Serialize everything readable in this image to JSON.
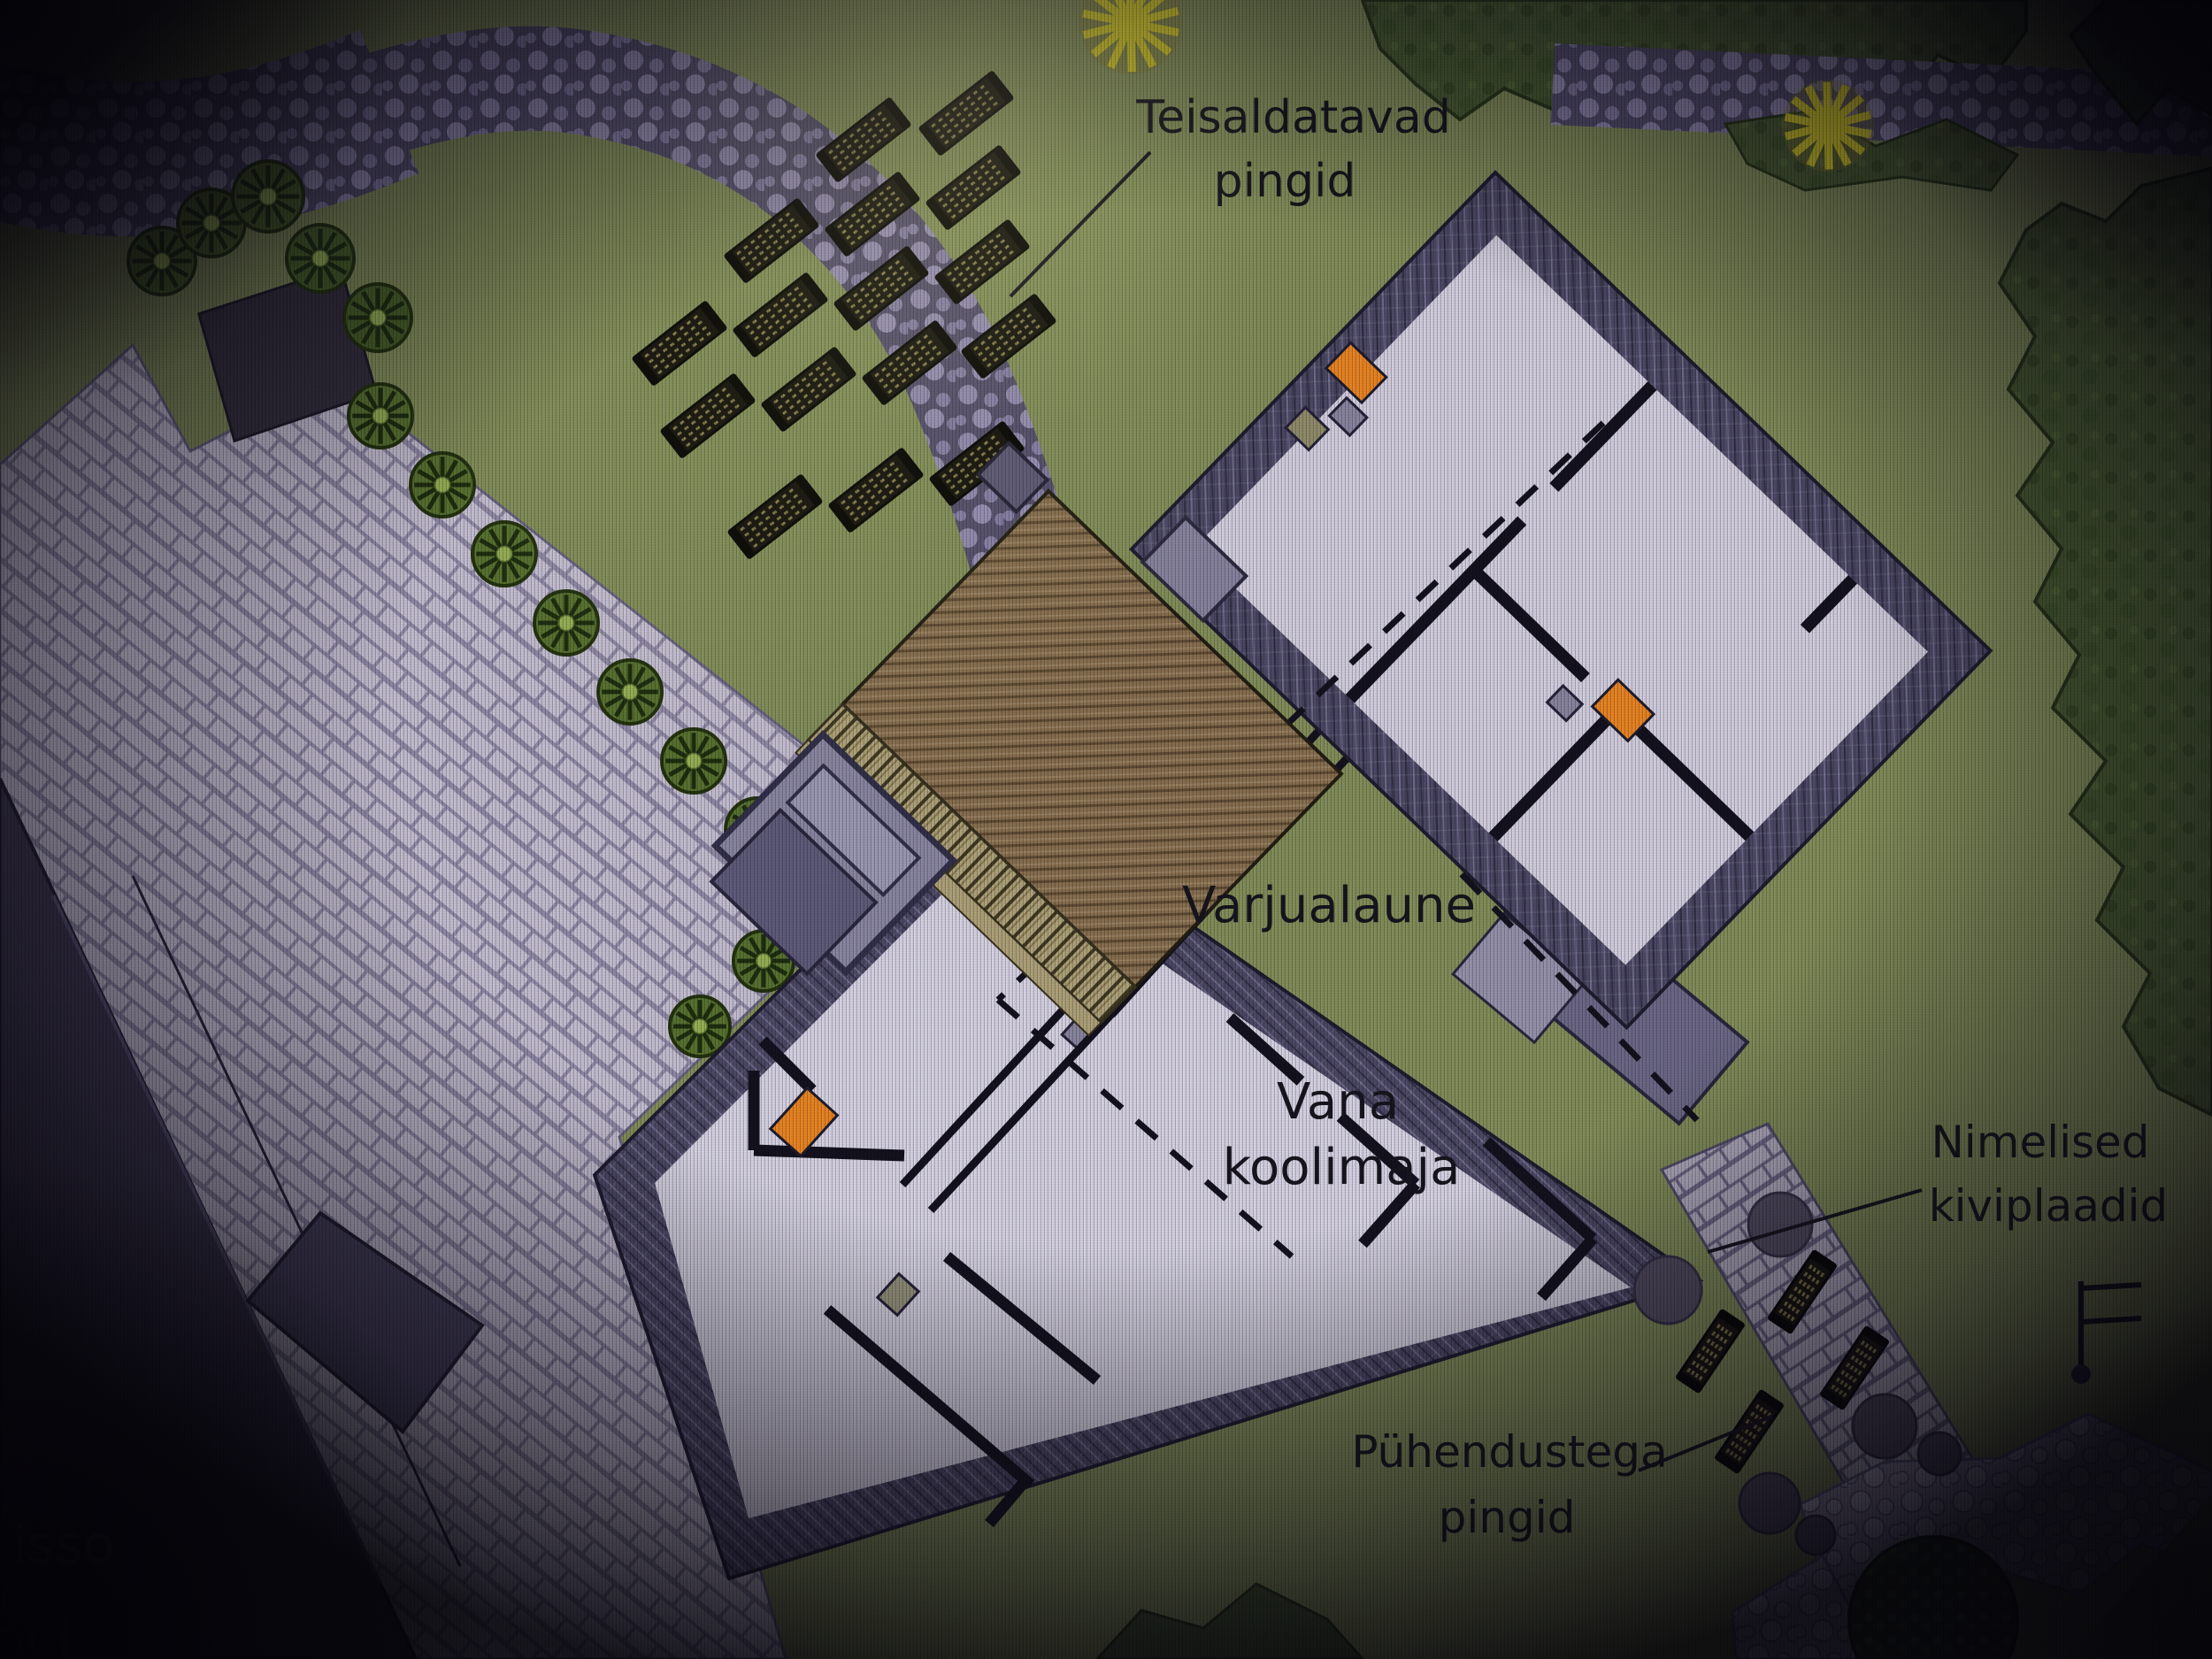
{
  "labels": {
    "teisaldatavad": {
      "line1": "Teisaldatavad",
      "line2": "pingid"
    },
    "varjualaune": {
      "line1": "Varjualaune"
    },
    "vana_koolimaja": {
      "line1": "Vana",
      "line2": "koolimaja"
    },
    "nimelised": {
      "line1": "Nimelised",
      "line2": "kiviplaadid"
    },
    "puhendustega": {
      "line1": "Pühendustega",
      "line2": "pingid"
    },
    "partial_building_text": {
      "line1": "isso",
      "line2": "ool"
    }
  },
  "counts": {
    "movable_benches": 16,
    "dedication_benches": 4,
    "edge_row_trees": 10,
    "cluster_trees": 5,
    "yellow_star_trees": 2,
    "round_bollard_trees": 6
  },
  "colors": {
    "accent_orange": "#ef8824",
    "roof_brown": "#8b7252",
    "lawn_green": "#86925c",
    "wall_band_dark": "#4e4a68",
    "floor_lavender": "#d8d4e4",
    "plaza_paving": "#c9c3d6",
    "tree_green": "#5a7531",
    "canopy_dark_green": "#4c5f33",
    "path_stone": "#958db4",
    "label_ink": "#17151f"
  }
}
